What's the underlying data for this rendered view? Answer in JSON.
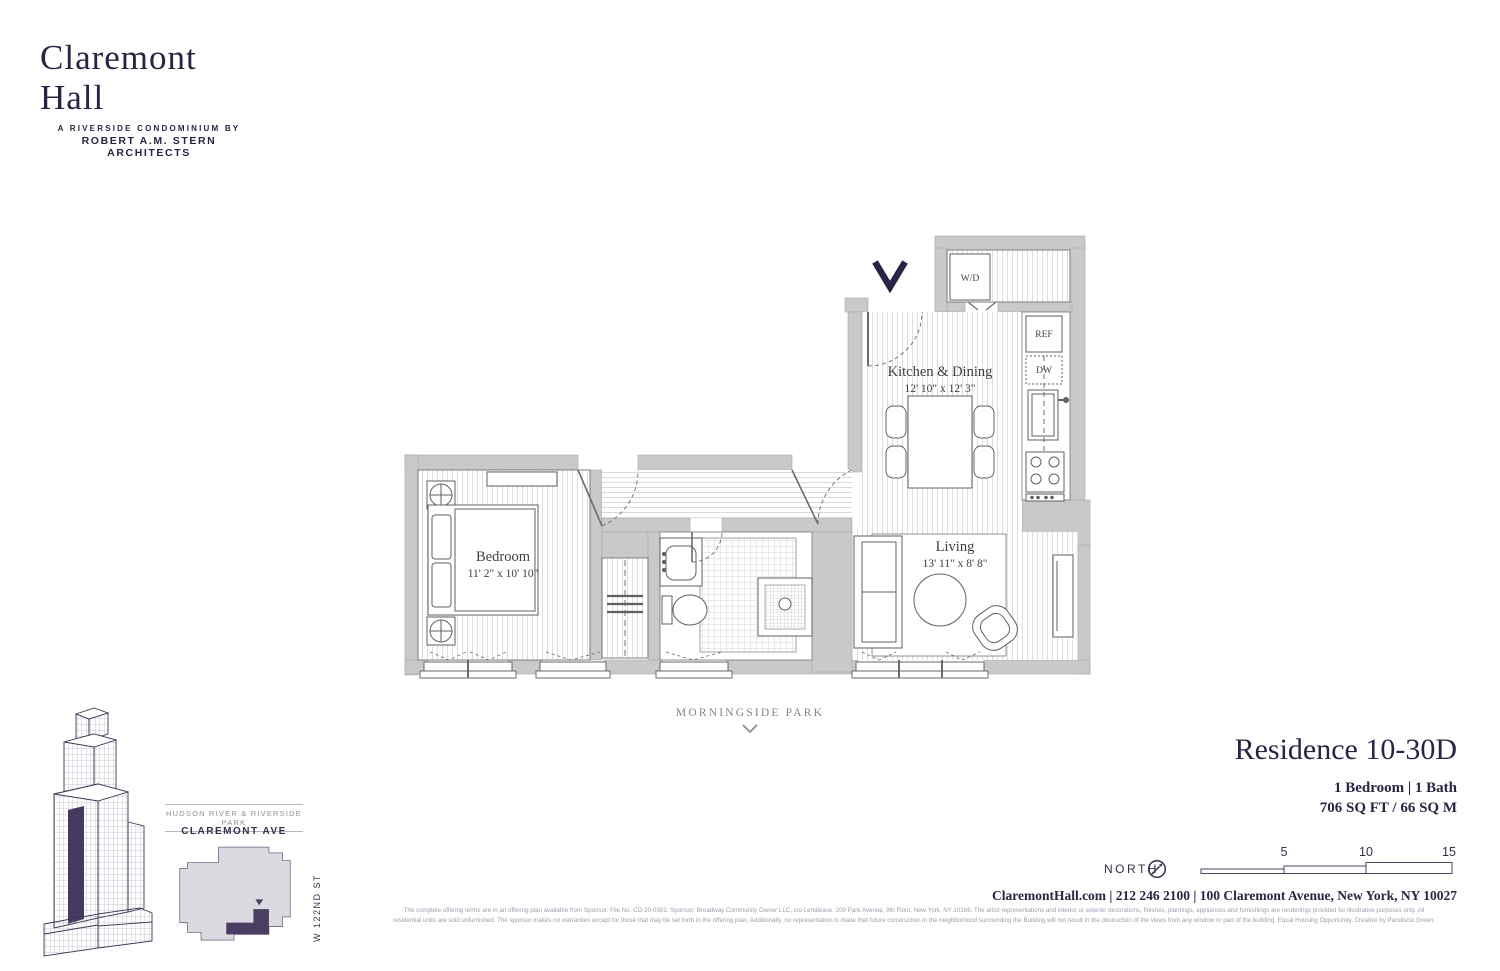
{
  "brand": {
    "name": "Claremont Hall",
    "tagline_line1": "A RIVERSIDE CONDOMINIUM BY",
    "tagline_line2": "ROBERT A.M. STERN ARCHITECTS"
  },
  "floorplan": {
    "rooms": [
      {
        "name": "Kitchen & Dining",
        "dims": "12' 10\" x 12' 3\""
      },
      {
        "name": "Bedroom",
        "dims": "11' 2\" x 10' 10\""
      },
      {
        "name": "Living",
        "dims": "13' 11\" x 8' 8\""
      }
    ],
    "appliances": {
      "washer_dryer": "W/D",
      "refrigerator": "REF",
      "dishwasher": "DW"
    }
  },
  "map_context": {
    "park_label": "MORNINGSIDE PARK"
  },
  "keyplan": {
    "river_label": "HUDSON RIVER & RIVERSIDE PARK",
    "avenue_label": "CLAREMONT AVE",
    "street_label": "W 122ND ST"
  },
  "residence": {
    "title": "Residence 10-30D",
    "specs": "1 Bedroom | 1 Bath",
    "area": "706 SQ FT / 66 SQ M"
  },
  "compass": {
    "label": "NORTH"
  },
  "scalebar": {
    "ticks": [
      "5",
      "10",
      "15"
    ]
  },
  "contact": {
    "line": "ClaremontHall.com | 212 246 2100 | 100 Claremont Avenue, New York, NY 10027"
  },
  "legal": {
    "line1": "The complete offering terms are in an offering plan available from Sponsor. File No. CD-20-0302. Sponsor: Broadway Community Owner LLC, c/o Lendlease, 200 Park Avenue, 9th Floor, New York, NY 10166. The artist representations and interior or exterior decorations, finishes, plantings, appliances and furnishings are renderings provided for illustrative purposes only. All",
    "line2": "residential units are sold unfurnished. The sponsor makes no warranties except for those that may be set forth in the offering plan. Additionally, no representation is made that future construction in the neighborhood surrounding the Building will not result in the obstruction of the views from any window or part of the building. Equal Housing Opportunity. Creative by Pandiscio Green."
  },
  "colors": {
    "brand": "#2b2248",
    "wall": "#c9c9c9",
    "plan_line": "#5f5f66",
    "unit_highlight": "#4a3f63",
    "footprint": "#dbdae0"
  }
}
